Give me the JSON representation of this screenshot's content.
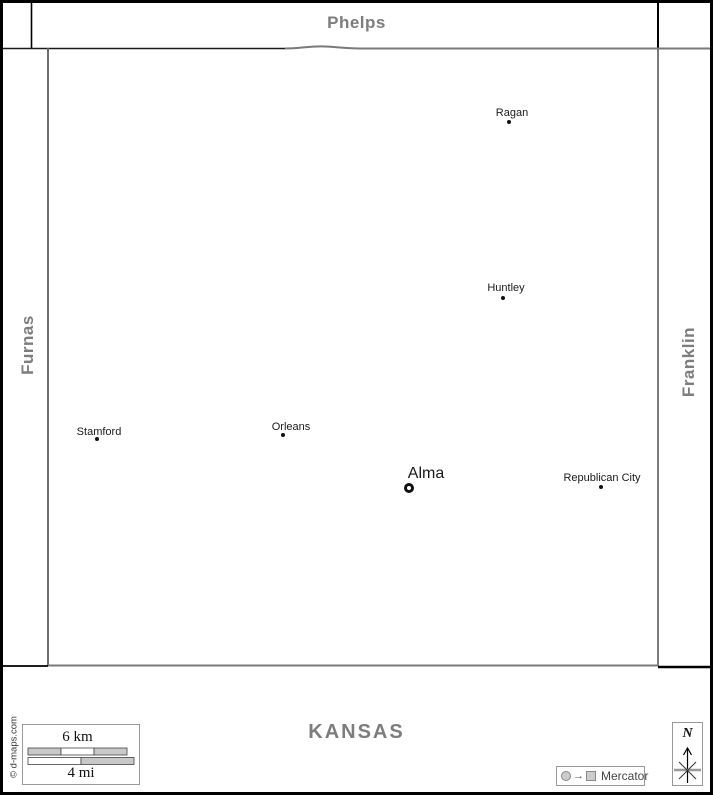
{
  "map": {
    "region": {
      "north": "Phelps",
      "west": "Furnas",
      "east": "Franklin",
      "south": "KANSAS"
    },
    "towns": [
      {
        "name": "Ragan",
        "marker": "dot",
        "marker_x": 509,
        "marker_y": 122,
        "label_x": 512,
        "label_y": 113,
        "county_seat": false
      },
      {
        "name": "Huntley",
        "marker": "dot",
        "marker_x": 503,
        "marker_y": 298,
        "label_x": 506,
        "label_y": 288,
        "county_seat": false
      },
      {
        "name": "Stamford",
        "marker": "dot",
        "marker_x": 97,
        "marker_y": 439,
        "label_x": 99,
        "label_y": 432,
        "county_seat": false
      },
      {
        "name": "Orleans",
        "marker": "dot",
        "marker_x": 283,
        "marker_y": 435,
        "label_x": 291,
        "label_y": 427,
        "county_seat": false
      },
      {
        "name": "Alma",
        "marker": "ring",
        "marker_x": 409,
        "marker_y": 488,
        "label_x": 426,
        "label_y": 474,
        "county_seat": true
      },
      {
        "name": "Republican City",
        "marker": "dot",
        "marker_x": 601,
        "marker_y": 487,
        "label_x": 602,
        "label_y": 478,
        "county_seat": false
      }
    ],
    "scale_bar": {
      "km": "6 km",
      "mi": "4 mi"
    },
    "projection": "Mercator",
    "compass_north": "N",
    "credit": "© d-maps.com",
    "colors": {
      "region_label": "#7d7d7d",
      "boundary_gray": "#7a7a7a",
      "boundary_black": "#000000",
      "town_label": "#1a1a1a",
      "scale_fill": "#c9c9c9"
    }
  }
}
